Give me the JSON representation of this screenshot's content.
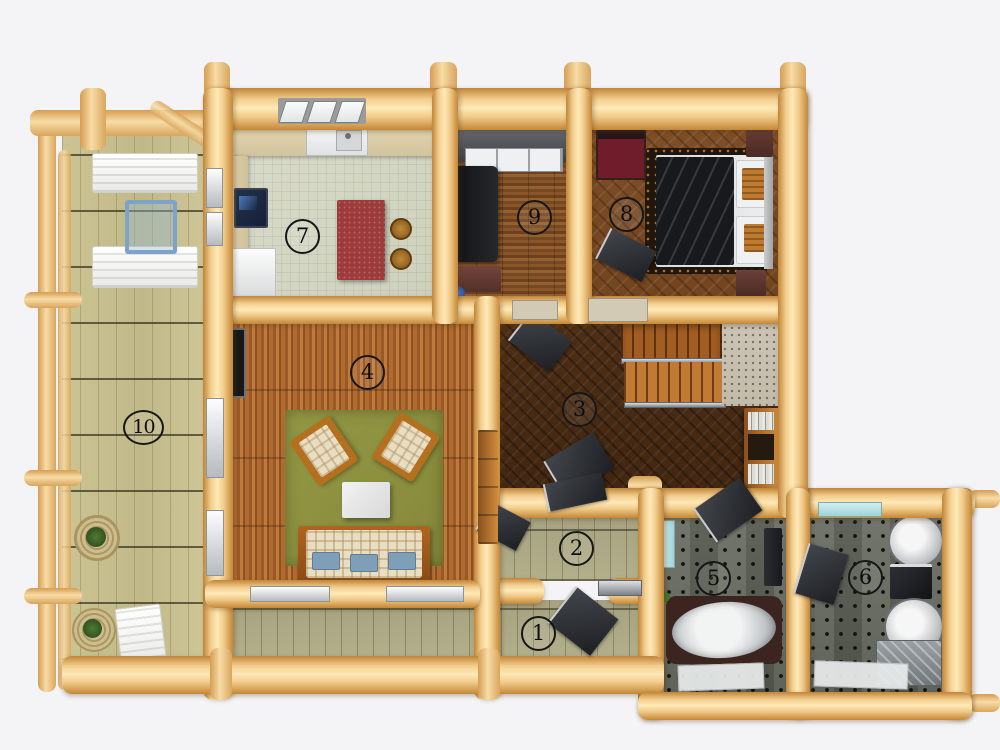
{
  "scene": {
    "description": "3D top-down floor plan rendering of a log house",
    "view": "top-down",
    "room_count": 10
  },
  "rooms": [
    {
      "label": "1"
    },
    {
      "label": "2"
    },
    {
      "label": "3"
    },
    {
      "label": "4"
    },
    {
      "label": "5"
    },
    {
      "label": "6"
    },
    {
      "label": "7"
    },
    {
      "label": "8"
    },
    {
      "label": "9"
    },
    {
      "label": "10"
    }
  ],
  "palette": {
    "background": "#f4f4f6",
    "log_wood": "#f0c885",
    "log_shadow": "#c08438",
    "deck_planks": "#c8c095",
    "porch_planks": "#a8a584",
    "kitchen_tile": "#d6d9c5",
    "kitchen_counter": "#ddd0ab",
    "kitchen_island_red": "#9c3a3c",
    "study_floor": "#84542a",
    "bedroom_floor": "#7c4e27",
    "hall_floor": "#4c2d16",
    "living_floor": "#ad6a2e",
    "living_rug_green": "#8d9340",
    "bath_tile": "#63665e",
    "sofa_cream": "#e6dcc0",
    "pillow_blue": "#7f9eb8",
    "stair_wood": "#b06a28",
    "number_ink": "#161616"
  }
}
